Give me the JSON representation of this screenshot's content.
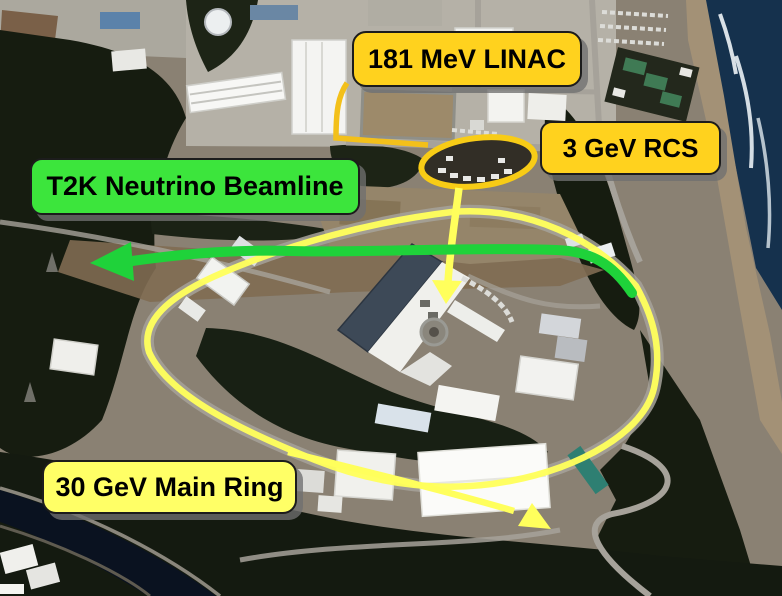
{
  "labels": {
    "linac": {
      "text": "181 MeV LINAC",
      "bg_color": "#FFD21E"
    },
    "rcs": {
      "text": "3 GeV RCS",
      "bg_color": "#FFD21E"
    },
    "t2k": {
      "text": "T2K Neutrino Beamline",
      "bg_color": "#3CE53C"
    },
    "main_ring": {
      "text": "30 GeV Main Ring",
      "bg_color": "#FFFF66"
    }
  },
  "annotations": {
    "colors": {
      "gold_outline": "#F3C01A",
      "pale_yellow_ring": "#FFFF5C",
      "green_beam": "#1FD23A"
    },
    "markers": [
      {
        "name": "rcs-ring-outline",
        "shape": "small-ellipse",
        "color": "#F8CC16"
      },
      {
        "name": "main-ring-outline",
        "shape": "large-loop",
        "color": "#FFFF5C"
      },
      {
        "name": "linac-pointer-line",
        "shape": "bracket-line",
        "color": "#F3C01A"
      },
      {
        "name": "down-arrow",
        "shape": "arrow-down",
        "color": "#FFFF5C"
      },
      {
        "name": "down-right-arrow",
        "shape": "arrow-down-right",
        "color": "#FFFF5C"
      },
      {
        "name": "left-green-arrow",
        "shape": "arrow-left",
        "color": "#1FD23A"
      }
    ]
  }
}
